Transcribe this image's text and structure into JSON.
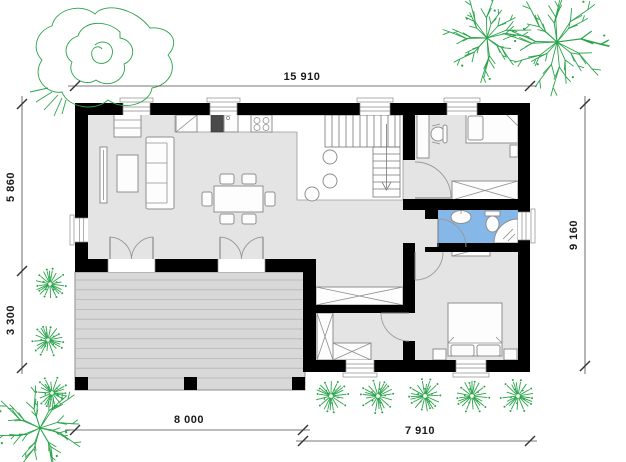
{
  "dimensions": {
    "top": "15 910",
    "left_upper": "5 860",
    "left_lower": "3 300",
    "right": "9 160",
    "bottom_left": "8 000",
    "bottom_right": "7 910"
  },
  "colors": {
    "walls": "#000000",
    "floor": "#e4e4e4",
    "kitchen_floor": "#ffffff",
    "bathroom_floor": "#85b7e8",
    "terrace_deck": "#d8d8d8",
    "vegetation": "#2aa44a",
    "dimension_text": "#1a1a1a",
    "background": "#ffffff"
  },
  "vegetation_icons": [
    "scribble-tree",
    "fern-tree",
    "round-bush"
  ]
}
